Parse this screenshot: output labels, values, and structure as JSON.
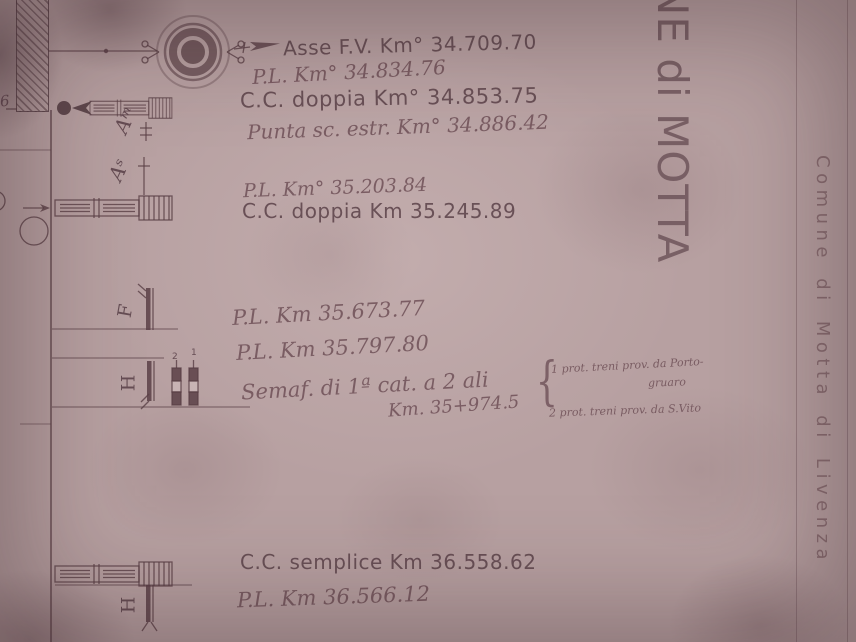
{
  "title": {
    "station": "NE di MOTTA",
    "comune": "Comune di Motta di Livenza"
  },
  "margin": {
    "left_number": "6"
  },
  "annotations": {
    "asse": "Asse F.V. Km° 34.709.70",
    "pl_34834": "P.L. Km° 34.834.76",
    "cc_doppia_34853": "C.C. doppia Km° 34.853.75",
    "punta_34886": "Punta sc. estr. Km° 34.886.42",
    "pl_35203": "P.L. Km° 35.203.84",
    "cc_doppia_35245": "C.C. doppia Km 35.245.89",
    "pl_35673": "P.L. Km 35.673.77",
    "pl_35797": "P.L. Km 35.797.80",
    "semaforo": "Semaf. di 1ª cat. a 2 ali",
    "semaforo_km": "Km. 35+974.5",
    "brace": "{",
    "prot_1_line1": "1 prot. treni prov. da Porto-",
    "prot_1_line2": "gruaro",
    "prot_2": "2 prot. treni prov. da S.Vito",
    "cc_semplice_36558": "C.C. semplice Km 36.558.62",
    "pl_36566": "P.L. Km 36.566.12"
  },
  "signals": {
    "am_label": "Aᵐ",
    "as_label": "Aˢ",
    "f_label": "F",
    "h_label": "H",
    "h2_label": "H",
    "wing_1": "1",
    "wing_2": "2"
  },
  "colors": {
    "paper": "#b7a0a1",
    "ink": "#62494f",
    "ink_faint": "#8a6c72"
  }
}
